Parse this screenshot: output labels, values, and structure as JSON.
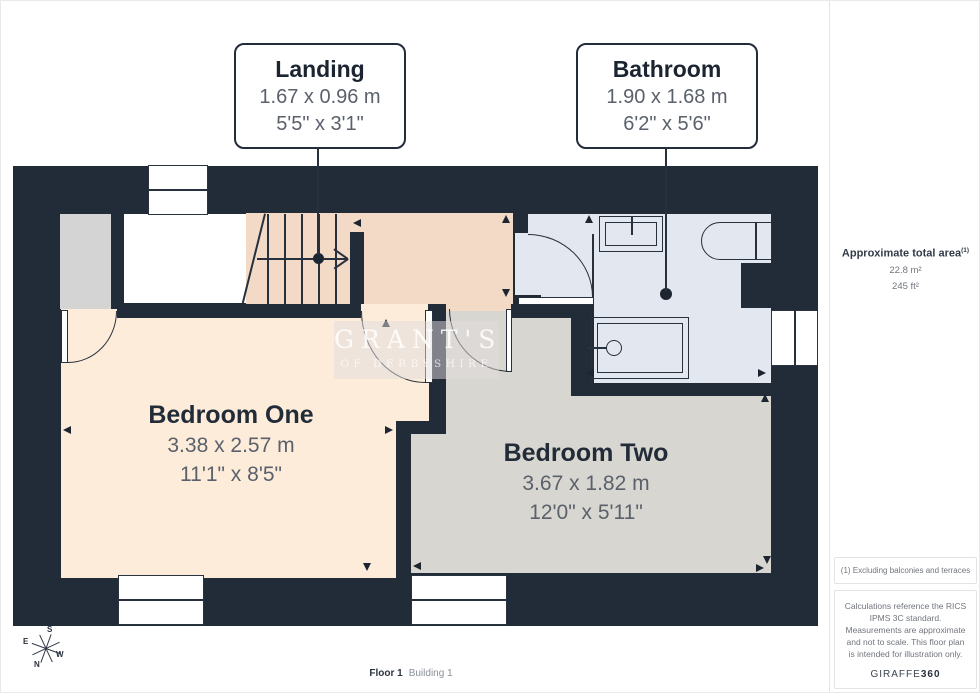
{
  "labels": {
    "landing": {
      "name": "Landing",
      "metric": "1.67 x 0.96 m",
      "imperial": "5'5\" x 3'1\""
    },
    "bathroom": {
      "name": "Bathroom",
      "metric": "1.90 x 1.68 m",
      "imperial": "6'2\" x 5'6\""
    },
    "bedroom_one": {
      "name": "Bedroom One",
      "metric": "3.38 x 2.57 m",
      "imperial": "11'1\" x 8'5\""
    },
    "bedroom_two": {
      "name": "Bedroom Two",
      "metric": "3.67 x 1.82 m",
      "imperial": "12'0\" x 5'11\""
    }
  },
  "sidebar": {
    "area_title": "Approximate total area",
    "area_note_ref": "(1)",
    "area_m2": "22.8 m²",
    "area_ft2": "245 ft²",
    "note1": "(1) Excluding balconies and terraces",
    "note2": "Calculations reference the RICS IPMS 3C standard. Measurements are approximate and not to scale. This floor plan is intended for illustration only.",
    "brand": "GIRAFFE",
    "brand_suffix": "360"
  },
  "footer": {
    "floor": "Floor 1",
    "building": "Building 1"
  },
  "compass": {
    "n": "N",
    "s": "S",
    "e": "E",
    "w": "W"
  },
  "watermark": {
    "line1": "GRANT'S",
    "line2": "OF DERBYSHIRE"
  },
  "colors": {
    "wall": "#222b38",
    "landing_floor": "#f3dac6",
    "bedroom_one_floor": "#fdecda",
    "bedroom_two_floor": "#d8d6d0",
    "bathroom_floor": "#e3e7ef",
    "closet_floor": "#d4d4d4",
    "dim_text": "#5a616b"
  }
}
